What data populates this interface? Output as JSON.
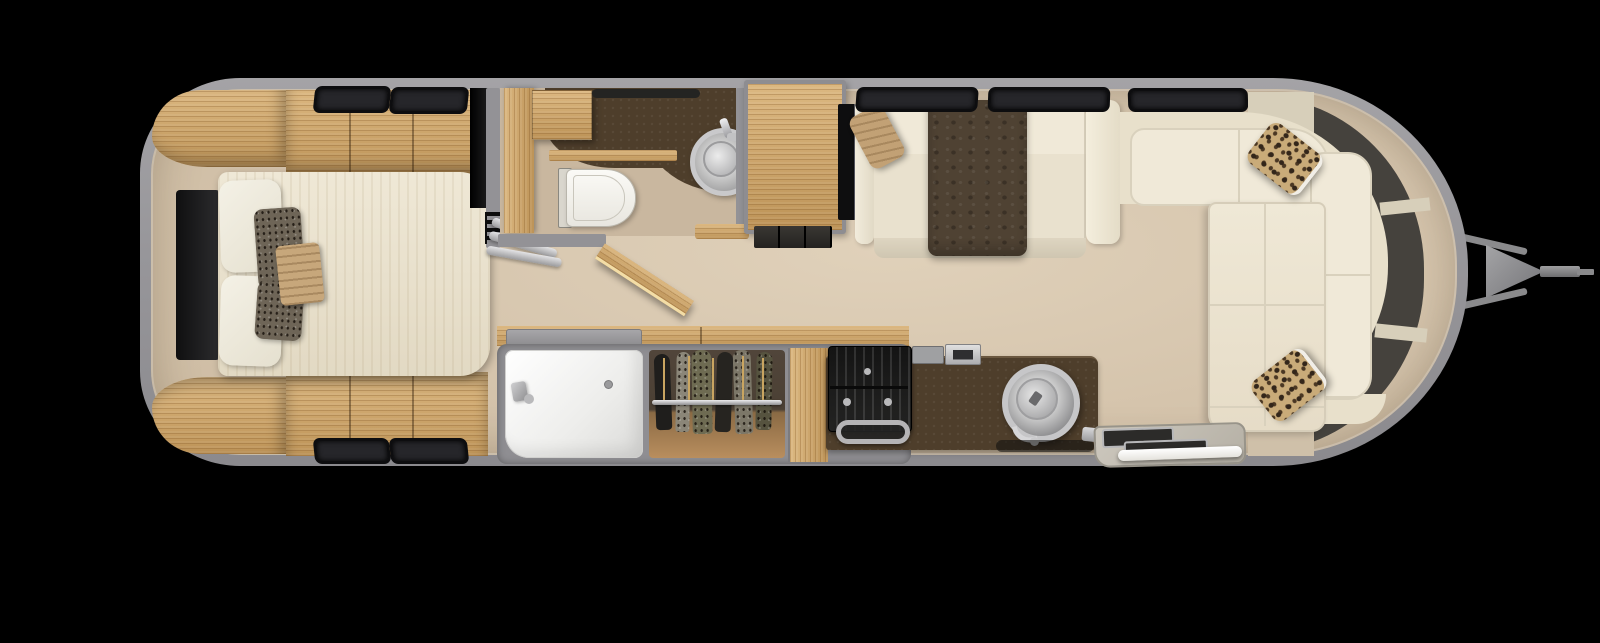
{
  "scene": {
    "label": "Top-down 3D floor plan render of a travel trailer with tow hitch on the right",
    "view": "plan",
    "background_color": "#000000"
  },
  "palette": {
    "shell_gray": "#97969a",
    "floor_beige": "#d2c1a8",
    "wood": "#cda76e",
    "counter_brown": "#4e3e2b",
    "window_dark": "#45423d",
    "cream_upholstery": "#ece4d1",
    "white_fixture": "#f4f3ef",
    "throw_brown": "#4f4233",
    "accent_tan": "#c2a175",
    "leopard_base": "#c9ab79",
    "stainless": "#c6c6c8",
    "black_appliance": "#1a1a1a"
  },
  "zones": {
    "bedroom": {
      "name": "Rear bedroom (left)",
      "items": [
        "curved corner wardrobe top",
        "curved corner wardrobe bottom",
        "overhead cabinet top",
        "overhead cabinet bottom",
        "wall TV",
        "bed",
        "white pillows x2",
        "patterned pillows x2",
        "tan accent pillow",
        "windows x4"
      ]
    },
    "bathroom": {
      "name": "Bathroom (top center)",
      "items": [
        "toilet",
        "round vessel sink",
        "dark vanity counter",
        "wood cabinet column",
        "wood cabinet box",
        "ceiling vent",
        "open wood door",
        "accordion door"
      ]
    },
    "closet_bay": {
      "name": "Shower & wardrobe bay (bottom center)",
      "items": [
        "white shower stall",
        "shower head",
        "drain",
        "hanging wardrobe",
        "closet rod",
        "hanging clothes x6",
        "wood end panel",
        "wood counter top with hatch"
      ]
    },
    "kitchen": {
      "name": "Galley kitchen (bottom)",
      "items": [
        "black cooktop with burner grates",
        "knobs x3",
        "oven handle",
        "dark countertop",
        "round stainless sink",
        "faucet",
        "counter appliances x2",
        "floor mat shadow"
      ]
    },
    "dinette": {
      "name": "Side table",
      "items": [
        "wood table top",
        "dark pedestal base"
      ]
    },
    "sofa": {
      "name": "Mid sofa (top)",
      "items": [
        "TV strip",
        "left armrest",
        "right armrest",
        "back cushions",
        "seat cushions",
        "front skirt",
        "brown throw blanket",
        "tan accent pillow",
        "windows x3"
      ]
    },
    "lounge": {
      "name": "Front wraparound lounge (right)",
      "items": [
        "U-shaped cream sofa",
        "back cushions",
        "chaise cushion",
        "leopard pillow upper",
        "leopard pillow lower",
        "wraparound tinted window band (3 segments)"
      ]
    },
    "entry": {
      "name": "Entry step (bottom right)",
      "items": [
        "step mat",
        "metal treads x2",
        "white threshold edge",
        "silver step bar"
      ]
    },
    "exterior": {
      "name": "Tow hitch (right)",
      "items": [
        "A-frame bar upper",
        "A-frame bar lower",
        "tongue triangle",
        "coupler",
        "coupler tip"
      ]
    }
  }
}
